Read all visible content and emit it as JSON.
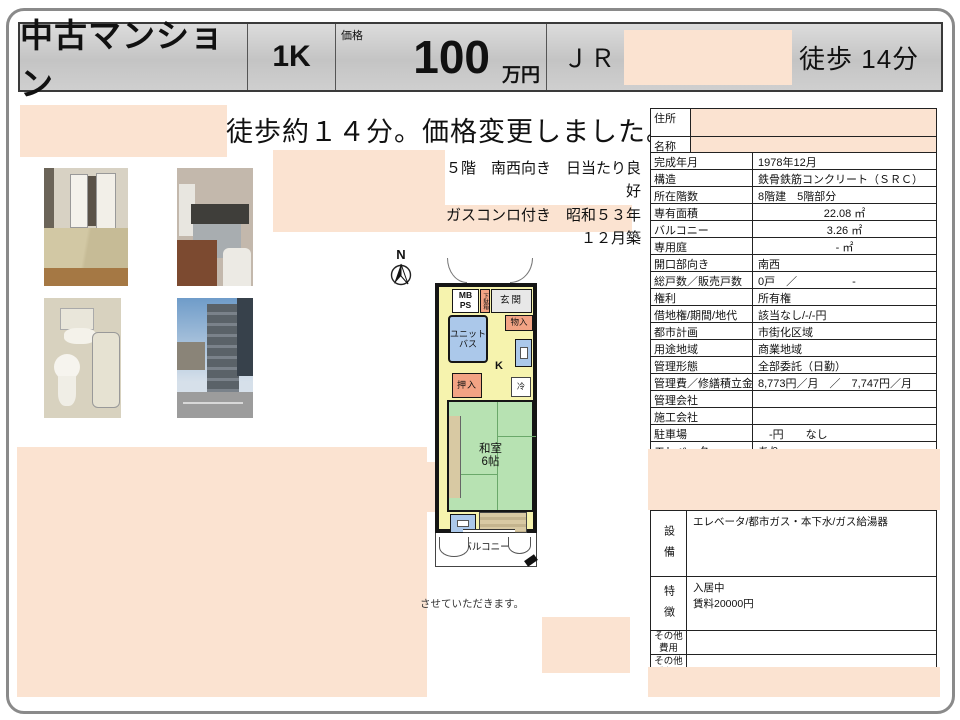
{
  "header": {
    "property_type": "中古マンション",
    "layout": "1K",
    "price_label": "価格",
    "price_value": "100",
    "price_unit": "万円",
    "rail_line": "ＪＲ",
    "walk": "徒歩 14分"
  },
  "lead": {
    "headline": "徒歩約１４分。価格変更しました。",
    "sub1": "５階　南西向き　日当たり良好",
    "sub2": "ガスコンロ付き　昭和５３年１２月築",
    "fine_print": "させていただきます。"
  },
  "floorplan": {
    "compass_n": "N",
    "mb_ps": "MB\nPS",
    "shoe_box": "下駄箱",
    "entrance": "玄関",
    "unit_bath": "ユニット\nバス",
    "storage": "物入",
    "kitchen": "K",
    "closet": "押入",
    "fridge": "冷",
    "tatami_room": "和室\n6帖",
    "balcony": "バルコニー"
  },
  "table": {
    "rows": [
      {
        "label": "住所",
        "value": ""
      },
      {
        "label": "名称",
        "value": ""
      },
      {
        "label": "完成年月",
        "value": "1978年12月"
      },
      {
        "label": "構造",
        "value": "鉄骨鉄筋コンクリート（ＳＲＣ）"
      },
      {
        "label": "所在階数",
        "value": "8階建　5階部分"
      },
      {
        "label": "専有面積",
        "value": "22.08 ㎡"
      },
      {
        "label": "バルコニー",
        "value": "3.26 ㎡"
      },
      {
        "label": "専用庭",
        "value": "- ㎡"
      },
      {
        "label": "開口部向き",
        "value": "南西"
      },
      {
        "label": "総戸数／販売戸数",
        "value": "0戸　／　　　　　-"
      },
      {
        "label": "権利",
        "value": "所有権"
      },
      {
        "label": "借地権/期間/地代",
        "value": "該当なし/-/-円"
      },
      {
        "label": "都市計画",
        "value": "市街化区域"
      },
      {
        "label": "用途地域",
        "value": "商業地域"
      },
      {
        "label": "管理形態",
        "value": "全部委託（日勤）"
      },
      {
        "label": "管理費／修繕積立金",
        "value": "8,773円／月　／　7,747円／月"
      },
      {
        "label": "管理会社",
        "value": ""
      },
      {
        "label": "施工会社",
        "value": ""
      },
      {
        "label": "駐車場",
        "value": "　-円　　なし"
      },
      {
        "label": "エレベータ",
        "value": "あり"
      }
    ],
    "facilities_label": "設備",
    "facilities_value": "エレベータ/都市ガス・本下水/ガス給湯器",
    "features_label": "特徴",
    "features_value": "入居中\n賃料20000円",
    "other_costs_label": "その他\n費用",
    "other_restrictions_label": "その他\n制限"
  }
}
